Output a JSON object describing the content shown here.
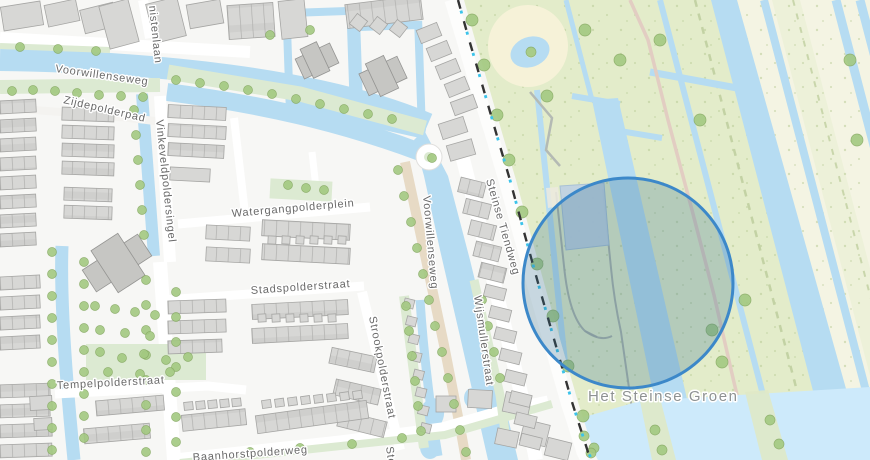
{
  "map_labels": {
    "partial_top_street": "nistenlaan",
    "voorwillenseweg_horizontal": "Voorwillenseweg",
    "zijdepolderpad": "Zijdepolderpad",
    "vinkeveldpoldersingel": "Vinkeveldpoldersingel",
    "watergangpolderplein": "Watergangpolderplein",
    "stadspolderstraat": "Stadspolderstraat",
    "tempelpolderstraat": "Tempelpolderstraat",
    "strookpolderstraat": "Strookpolderstraat",
    "voorwillenseweg_vertical": "Voorwillenseweg",
    "steinse_tiendweg": "Steinse Tiendweg",
    "wijsmullerstraat": "Wijsmullerstraat",
    "het_steinse_groen": "Het Steinse Groen",
    "baanhorstpolderweg": "Baanhorstpolderweg",
    "partial_bottom_street": "Ste"
  },
  "selection": {
    "shape": "circle",
    "center_x": 628,
    "center_y": 283,
    "radius": 105,
    "stroke_color": "#3c88c9",
    "fill_color": "rgba(47,107,142,0.26)",
    "has_selected_parcel": true
  },
  "colors": {
    "water": "#b6dcf2",
    "open_water": "#cdeafb",
    "park_green": "#e3ecca",
    "meadow_cream": "#f4f4e3",
    "garden_green": "#dcead2",
    "building_gray": "#d7d7d5",
    "road_white": "#ffffff",
    "sand_road": "#e7dac5",
    "path_dash_black": "#333333",
    "path_dash_cyan": "#3cc3ea",
    "selection_blue": "#3c88c9",
    "parcel_highlight": "#c0d2e3"
  }
}
